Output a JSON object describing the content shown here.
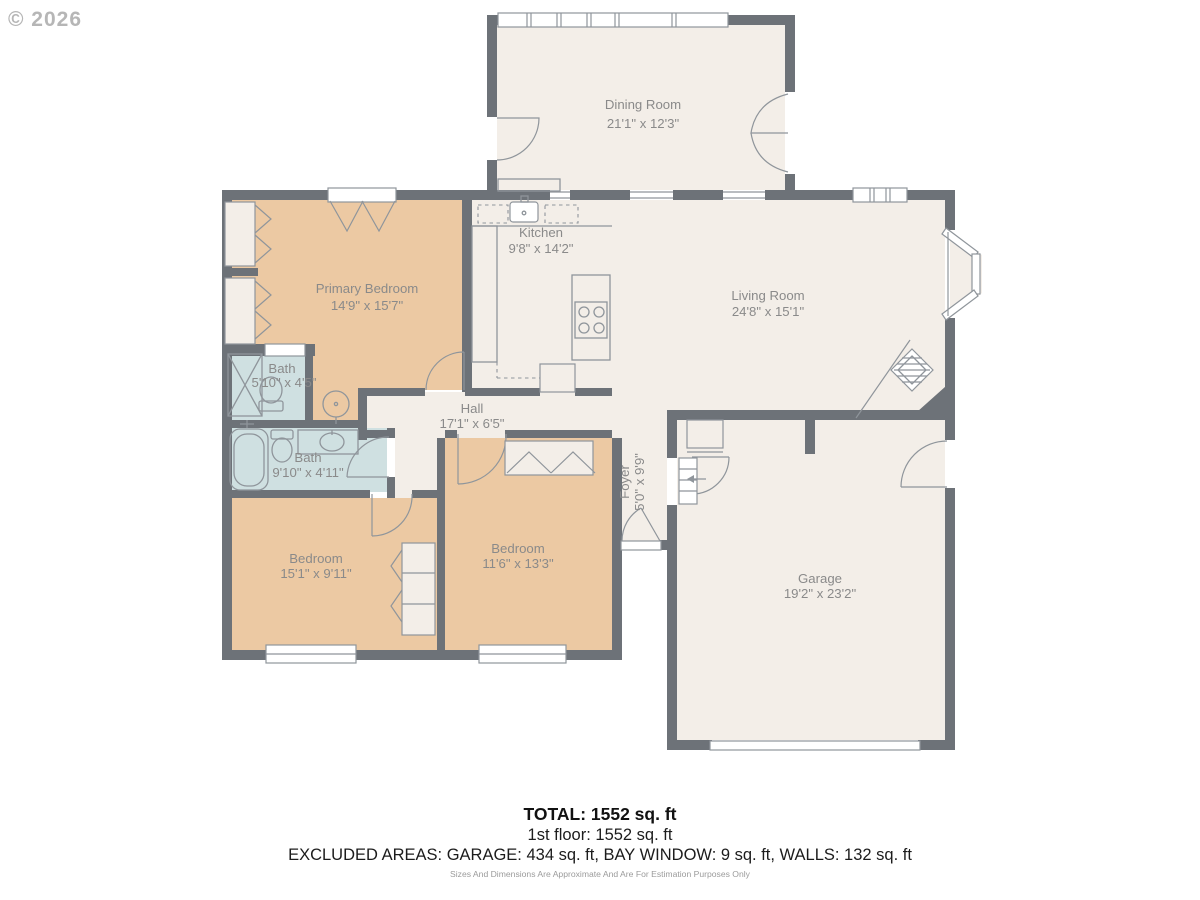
{
  "watermark": "© 2026",
  "rooms": {
    "dining": {
      "name": "Dining Room",
      "dims": "21'1\" x 12'3\""
    },
    "kitchen": {
      "name": "Kitchen",
      "dims": "9'8\" x 14'2\""
    },
    "living": {
      "name": "Living Room",
      "dims": "24'8\" x 15'1\""
    },
    "primary": {
      "name": "Primary Bedroom",
      "dims": "14'9\" x 15'7\""
    },
    "bath_small": {
      "name": "Bath",
      "dims": "5'10\" x 4'5\""
    },
    "bath_large": {
      "name": "Bath",
      "dims": "9'10\" x 4'11\""
    },
    "hall": {
      "name": "Hall",
      "dims": "17'1\" x 6'5\""
    },
    "foyer": {
      "name": "Foyer",
      "dims": "5'0\" x 9'9\""
    },
    "bedroom_left": {
      "name": "Bedroom",
      "dims": "15'1\" x 9'11\""
    },
    "bedroom_mid": {
      "name": "Bedroom",
      "dims": "11'6\" x 13'3\""
    },
    "garage": {
      "name": "Garage",
      "dims": "19'2\" x 23'2\""
    }
  },
  "summary": {
    "total": "TOTAL: 1552 sq. ft",
    "floor1": "1st floor: 1552 sq. ft",
    "excluded": "EXCLUDED AREAS: GARAGE: 434 sq. ft, BAY WINDOW: 9 sq. ft, WALLS: 132 sq. ft",
    "disclaimer": "Sizes And Dimensions Are Approximate And Are For Estimation Purposes Only"
  },
  "colors": {
    "wall": "#6d7278",
    "floor": "#f3eee8",
    "bedroom": "#ecc9a3",
    "bath": "#cfe0e1",
    "label": "#8a8a8a"
  }
}
